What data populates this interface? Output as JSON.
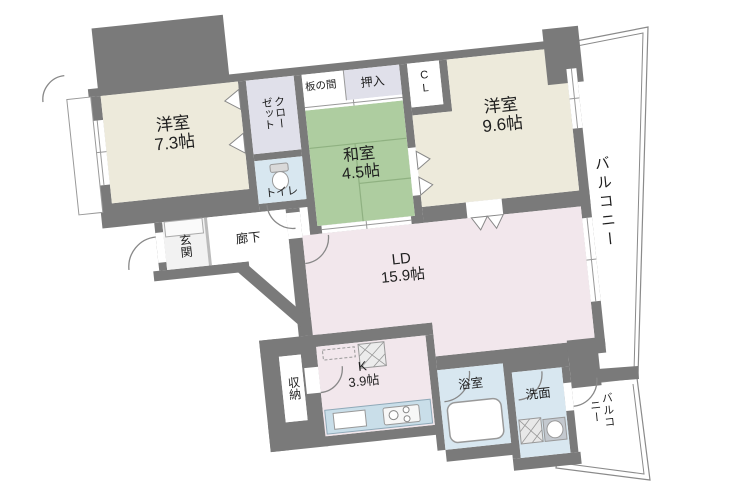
{
  "title": "apartment-floor-plan",
  "colors": {
    "wall": "#7a7a7a",
    "western": "#edeadb",
    "tatami": "#aecda0",
    "tatami_line": "#8fb181",
    "ld": "#f2e7ec",
    "wet": "#d8e7f0",
    "closet": "#e0e0ea",
    "counter": "#c9dee9",
    "white": "#ffffff",
    "outline": "#8a8a8a",
    "fixture": "#999999"
  },
  "rooms": {
    "western1": {
      "name": "洋室",
      "size": "7.3帖"
    },
    "western2": {
      "name": "洋室",
      "size": "9.6帖"
    },
    "japanese": {
      "name": "和室",
      "size": "4.5帖"
    },
    "living_dining": {
      "name": "LD",
      "size": "15.9帖"
    },
    "kitchen": {
      "name": "K",
      "size": "3.9帖"
    },
    "closet": {
      "label": "クロー\nゼット"
    },
    "cl": {
      "label": "C\nL"
    },
    "oshiire": {
      "label": "押入"
    },
    "itanoma": {
      "label": "板の間"
    },
    "toilet": {
      "label": "トイレ"
    },
    "genkan": {
      "label": "玄関"
    },
    "hallway": {
      "label": "廊下"
    },
    "storage": {
      "label": "収納"
    },
    "bathroom": {
      "label": "浴室"
    },
    "washroom": {
      "label": "洗面"
    },
    "balcony_main": {
      "label": "バルコニー"
    },
    "balcony_sub": {
      "label": "バルコニー"
    }
  }
}
